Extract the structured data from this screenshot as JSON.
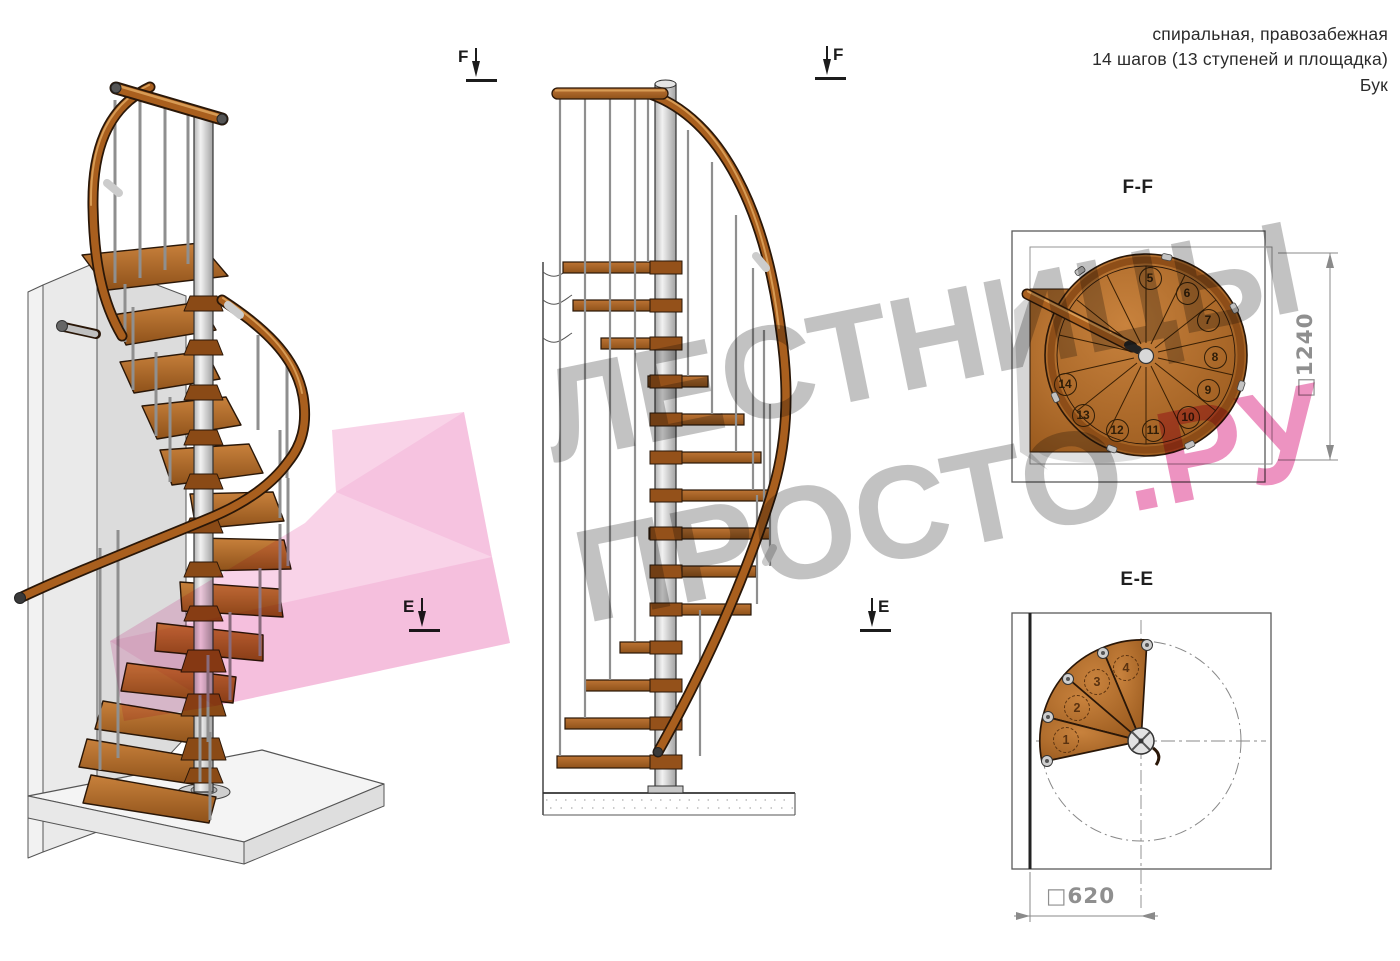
{
  "header": {
    "line1": "спиральная, правозабежная",
    "line2": "14 шагов (13 ступеней и площадка)",
    "line3": "Бук"
  },
  "sections": {
    "ff_title": "F-F",
    "ee_title": "E-E"
  },
  "markers": {
    "f": "F",
    "e": "E"
  },
  "dimensions": {
    "square_prefix": "□",
    "ff_size": "1240",
    "ee_size": "620"
  },
  "ff_view": {
    "step_numbers": [
      "5",
      "6",
      "7",
      "8",
      "9",
      "10",
      "11",
      "12",
      "13",
      "14"
    ]
  },
  "ee_view": {
    "step_numbers": [
      "1",
      "2",
      "3",
      "4"
    ]
  },
  "watermark": {
    "line1": "ЛЕСТНИЦЫ",
    "line2_gray": "ПРОСТО",
    "line2_pink": ".РУ"
  },
  "colors": {
    "wood": "#a95f1e",
    "wood_dark": "#7a4012",
    "outline": "#2a1708",
    "metal": "#d8d8d8",
    "wall": "#e6e6e6",
    "watermark_gray": "#8a8a8a",
    "watermark_pink": "#de3a8e",
    "dim_text": "#8f8f8f",
    "marker": "#1c1c1c",
    "ink": "#2b2b2b"
  }
}
